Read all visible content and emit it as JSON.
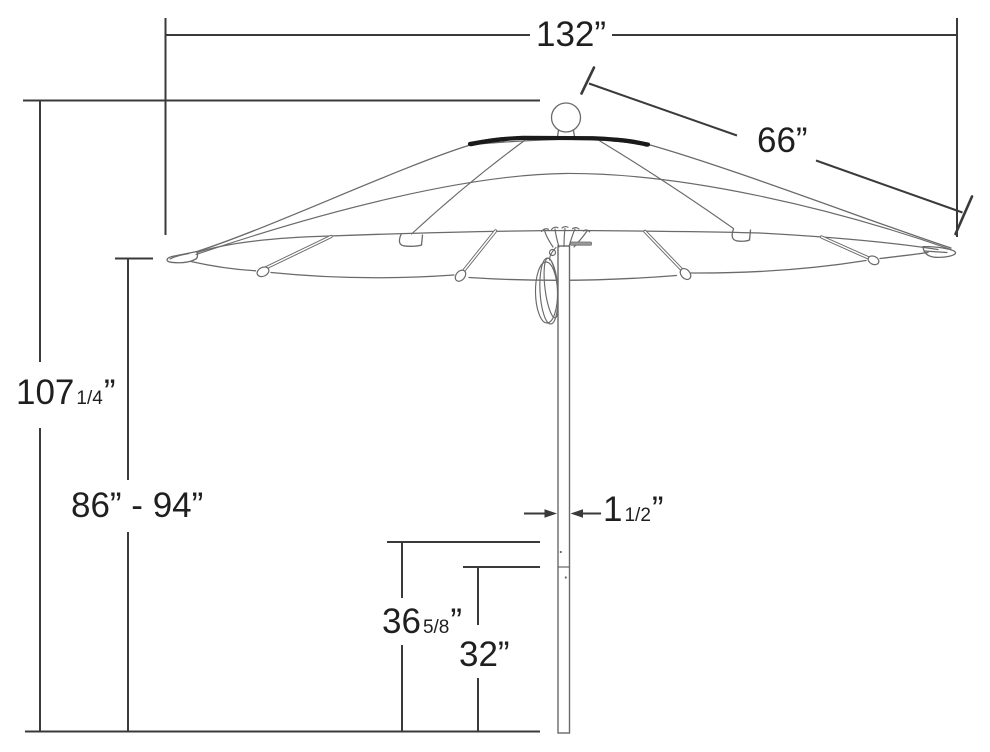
{
  "colors": {
    "background": "#ffffff",
    "dimension_line": "#3a3a3a",
    "umbrella_line": "#6a6a6a",
    "accent_black": "#1a1a1a",
    "text": "#1f1f1f",
    "pin_gray": "#9a9a9a"
  },
  "labels": {
    "canopy_width": {
      "text": "132”"
    },
    "rib_span": {
      "text": "66”"
    },
    "total_height": {
      "main": "107",
      "frac": "1/4",
      "unit": "”"
    },
    "pole_height_range": {
      "text": "86” - 94”"
    },
    "pole_diameter": {
      "main": "1",
      "frac": "1/2",
      "unit": "”"
    },
    "mid_height": {
      "main": "36",
      "frac": "5/8",
      "unit": "”"
    },
    "lower_height": {
      "text": "32”"
    }
  }
}
